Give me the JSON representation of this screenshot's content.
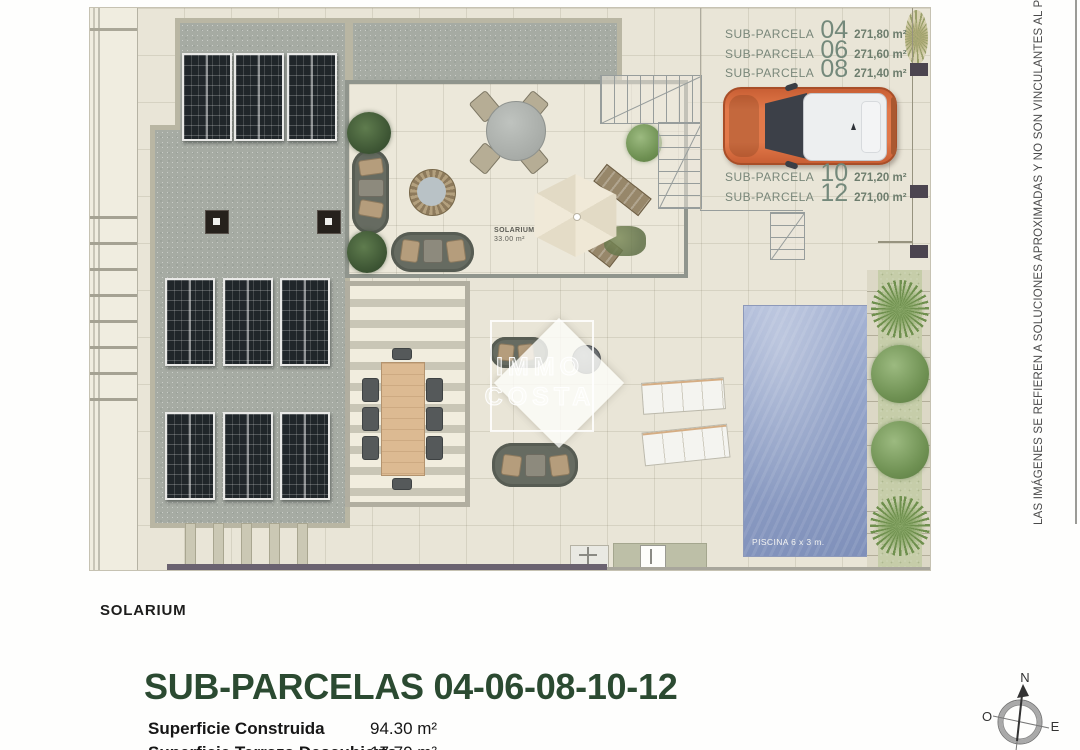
{
  "plan": {
    "parcels": [
      {
        "prefix": "SUB-PARCELA",
        "number": "04",
        "area": "271,80 m²"
      },
      {
        "prefix": "SUB-PARCELA",
        "number": "06",
        "area": "271,60 m²"
      },
      {
        "prefix": "SUB-PARCELA",
        "number": "08",
        "area": "271,40 m²"
      },
      {
        "prefix": "SUB-PARCELA",
        "number": "10",
        "area": "271,20 m²"
      },
      {
        "prefix": "SUB-PARCELA",
        "number": "12",
        "area": "271,00 m²"
      }
    ],
    "solarium": {
      "name": "SOLARIUM",
      "area": "33.00 m²"
    },
    "pool_label": "PISCINA 6 x 3 m."
  },
  "watermark": {
    "line1": "IMMO",
    "line2": "COSTA"
  },
  "disclaimer": "LAS IMÁGENES SE REFIEREN A SOLUCIONES APROXIMADAS Y NO SON VINCULANTES AL PROYECTO",
  "footer": {
    "solarium_caption": "SOLARIUM",
    "title": "SUB-PARCELAS 04-06-08-10-12",
    "rows": [
      {
        "label": "Superficie Construida",
        "value": "94.30 m²"
      },
      {
        "label": "Superficie Terraza Descubierto",
        "value": "17.70 m²"
      }
    ]
  },
  "compass": {
    "n": "N",
    "o": "O",
    "e": "E",
    "s": "S"
  },
  "colors": {
    "title_green": "#2b4a31",
    "car_orange": "#e2794a",
    "pool_blue": "#93a3c8",
    "gravel_gray": "#a6aba3",
    "wall_dark": "#6a6270"
  }
}
